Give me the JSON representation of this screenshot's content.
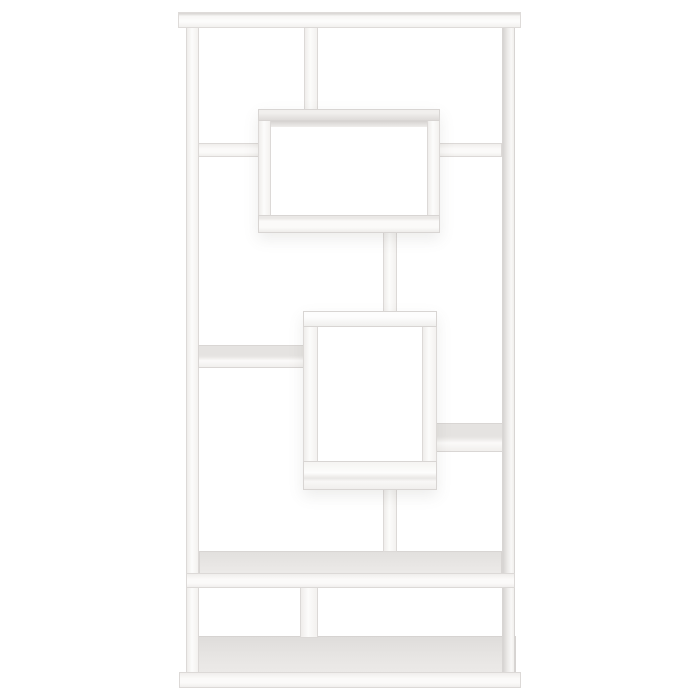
{
  "scene": {
    "alt": "White geometric bookcase product photo on a plain white background",
    "background": "#ffffff"
  },
  "palette": {
    "background": "#ffffff",
    "panel_face": "#fbfaf9",
    "panel_edge": "#d9d6d4",
    "top_surface_gray": "#e6e4e2",
    "inner_shade_gray": "#d5d2d0",
    "box_shadow": "rgba(110,105,100,0.12)"
  },
  "bookcase": {
    "parts": [
      {
        "name": "base-top-surface",
        "kind": "baset",
        "x": 186,
        "y": 636,
        "w": 330,
        "h": 39
      },
      {
        "name": "left-post",
        "kind": "vert",
        "x": 186,
        "y": 21,
        "w": 13,
        "h": 656
      },
      {
        "name": "right-post",
        "kind": "vertr",
        "x": 502,
        "y": 21,
        "w": 13,
        "h": 656
      },
      {
        "name": "top-bar",
        "kind": "bar",
        "x": 178,
        "y": 12,
        "w": 343,
        "h": 16
      },
      {
        "name": "top-left-shelf",
        "kind": "h",
        "x": 198,
        "y": 143,
        "w": 62,
        "h": 14
      },
      {
        "name": "top-right-shelf",
        "kind": "h",
        "x": 438,
        "y": 143,
        "w": 64,
        "h": 14
      },
      {
        "name": "top-divider",
        "kind": "vert",
        "x": 304,
        "y": 27,
        "w": 14,
        "h": 84
      },
      {
        "name": "middle-left-shelf",
        "kind": "htop2",
        "x": 198,
        "y": 345,
        "w": 107,
        "h": 23
      },
      {
        "name": "middle-right-shelf",
        "kind": "htop2",
        "x": 436,
        "y": 423,
        "w": 67,
        "h": 29
      },
      {
        "name": "long-shelf-top-surface",
        "kind": "top",
        "x": 199,
        "y": 551,
        "w": 303,
        "h": 24
      },
      {
        "name": "long-shelf-front",
        "kind": "h",
        "x": 186,
        "y": 573,
        "w": 329,
        "h": 15
      },
      {
        "name": "bottom-divider",
        "kind": "vert",
        "x": 300,
        "y": 587,
        "w": 18,
        "h": 51
      },
      {
        "name": "base-front",
        "kind": "h",
        "x": 179,
        "y": 672,
        "w": 342,
        "h": 16
      },
      {
        "name": "upper-box-connector",
        "kind": "vert",
        "x": 383,
        "y": 230,
        "w": 14,
        "h": 83
      },
      {
        "name": "lower-box-connector",
        "kind": "vert",
        "x": 383,
        "y": 488,
        "w": 14,
        "h": 64
      },
      {
        "name": "upper-box-drop-shadow",
        "kind": "shadow",
        "x": 258,
        "y": 109,
        "w": 182,
        "h": 124
      },
      {
        "name": "upper-box-left-wall",
        "kind": "vert",
        "x": 258,
        "y": 109,
        "w": 13,
        "h": 124
      },
      {
        "name": "upper-box-right-wall",
        "kind": "vert",
        "x": 427,
        "y": 109,
        "w": 13,
        "h": 124
      },
      {
        "name": "upper-box-top",
        "kind": "b1t",
        "x": 258,
        "y": 109,
        "w": 182,
        "h": 12
      },
      {
        "name": "upper-box-inner-shade",
        "kind": "strip",
        "x": 271,
        "y": 121,
        "w": 156,
        "h": 6
      },
      {
        "name": "upper-box-bottom",
        "kind": "b1b",
        "x": 258,
        "y": 215,
        "w": 182,
        "h": 18
      },
      {
        "name": "lower-box-drop-shadow",
        "kind": "shadow",
        "x": 303,
        "y": 311,
        "w": 134,
        "h": 179
      },
      {
        "name": "lower-box-left-wall",
        "kind": "vert",
        "x": 303,
        "y": 311,
        "w": 15,
        "h": 179
      },
      {
        "name": "lower-box-right-wall",
        "kind": "vert",
        "x": 422,
        "y": 311,
        "w": 15,
        "h": 179
      },
      {
        "name": "lower-box-top",
        "kind": "b2t",
        "x": 303,
        "y": 311,
        "w": 134,
        "h": 16
      },
      {
        "name": "lower-box-bottom",
        "kind": "b2b",
        "x": 303,
        "y": 461,
        "w": 134,
        "h": 29
      }
    ]
  }
}
